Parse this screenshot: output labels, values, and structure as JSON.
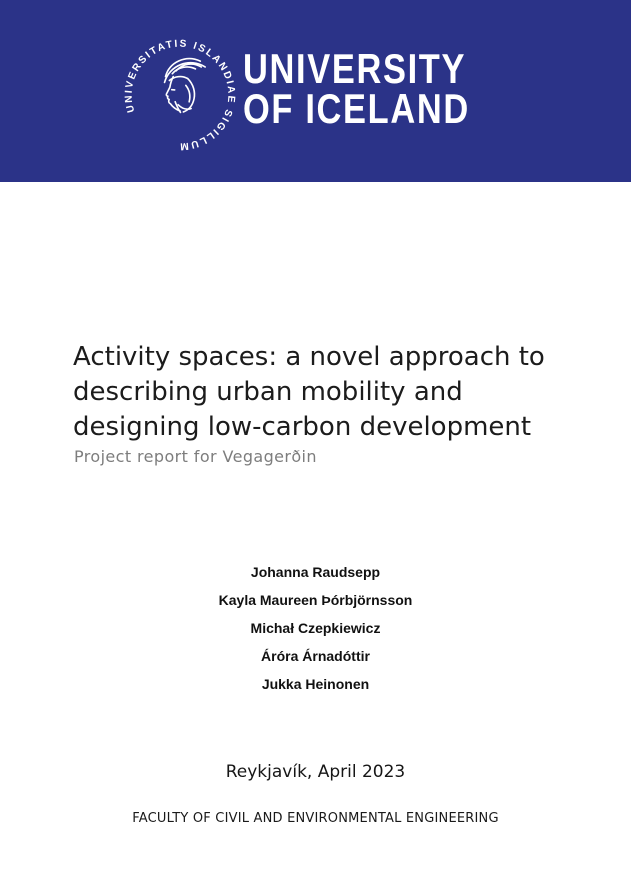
{
  "banner": {
    "background_color": "#2b3388",
    "wordmark_line1": "UNIVERSITY",
    "wordmark_line2": "OF ICELAND",
    "seal_text": "UNIVERSITATIS ISLANDIAE SIGILLUM"
  },
  "title": {
    "lines": {
      "0": "Activity spaces: a novel approach to",
      "1": "describing urban mobility and",
      "2": "designing low-carbon development"
    },
    "subtitle": "Project report for Vegagerðin"
  },
  "authors": [
    "Johanna Raudsepp",
    "Kayla Maureen Þórbjörnsson",
    "Michał Czepkiewicz",
    "Áróra Árnadóttir",
    "Jukka Heinonen"
  ],
  "imprint": {
    "place_date": "Reykjavík, April 2023",
    "faculty": "FACULTY OF CIVIL AND ENVIRONMENTAL ENGINEERING"
  },
  "colors": {
    "banner_blue": "#2b3388",
    "title_text": "#1c1c1c",
    "subtitle_gray": "#7d7d7d"
  }
}
